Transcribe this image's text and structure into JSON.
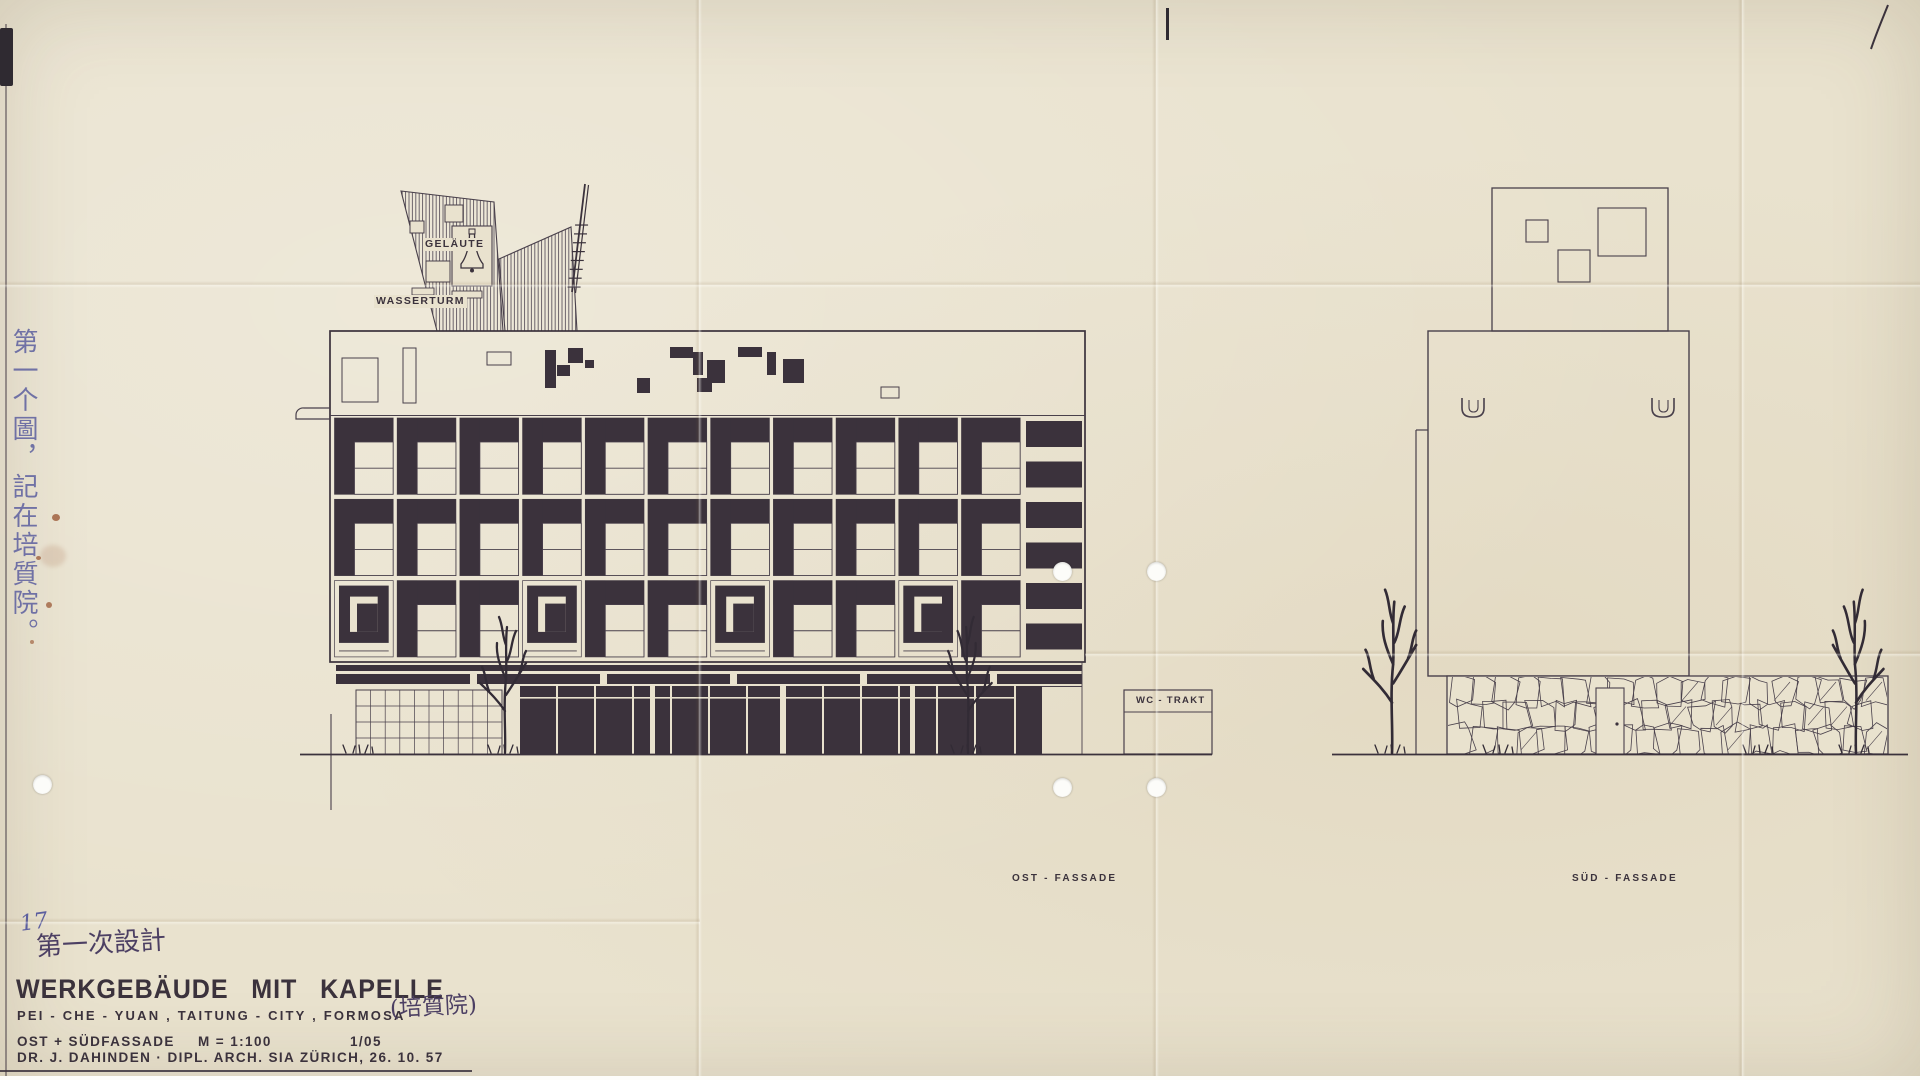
{
  "labels": {
    "gelaute": "GELÄUTE",
    "wasserturm": "WASSERTURM",
    "wc_trakt": "WC - TRAKT",
    "ost_fassade": "OST - FASSADE",
    "sud_fassade": "SÜD - FASSADE"
  },
  "annotations": {
    "sheet_number": "17",
    "first_design_note": "第一次設計",
    "margin_note": "第一个圖，記在培質院。",
    "name_chinese": "(培質院)"
  },
  "title_block": {
    "title": "WERKGEBÄUDE MIT KAPELLE",
    "location": "PEI - CHE - YUAN , TAITUNG - CITY , FORMOSA",
    "drawing": "OST + SÜDFASSADE",
    "scale": "M = 1:100",
    "sheet": "1/05",
    "architect": "DR. J. DAHINDEN · DIPL. ARCH. SIA ZÜRICH, 26. 10. 57"
  },
  "colors": {
    "paper": "#e9e2ce",
    "ink": "#3b323c",
    "line": "#49404b",
    "handwriting_blue": "#5c5f9f",
    "handwriting_purple": "#4c3f63",
    "stain_brown": "#96502c"
  }
}
